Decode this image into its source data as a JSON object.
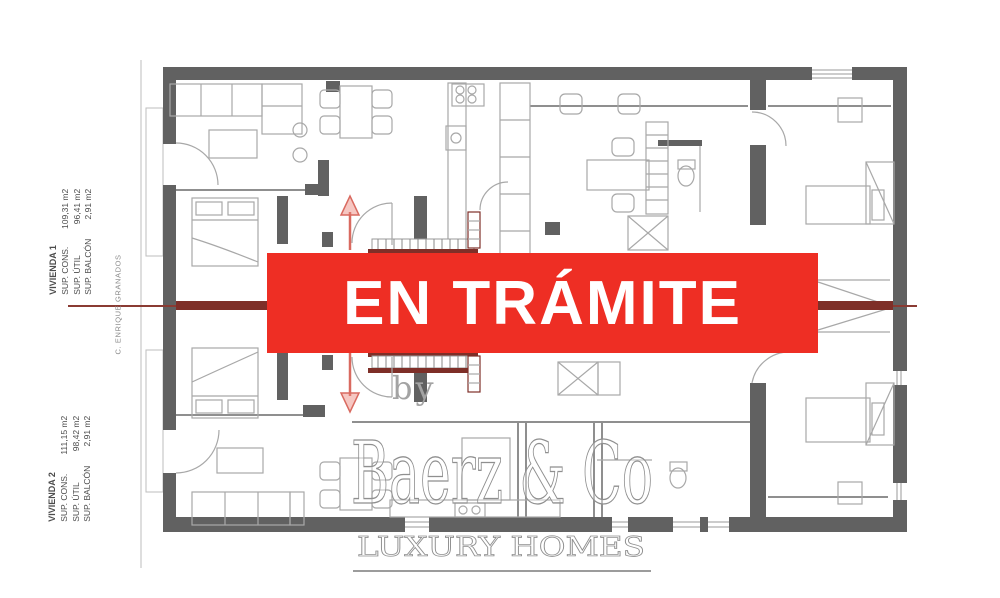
{
  "banner": {
    "text": "EN TRÁMITE",
    "bg_color": "#ee2e24",
    "text_color": "#ffffff"
  },
  "watermark": {
    "by": "by",
    "brand": "Baerz & Co",
    "tagline": "LUXURY HOMES"
  },
  "labels": {
    "vivienda1": {
      "title": "VIVIENDA 1",
      "rows": [
        {
          "name": "SUP. CONS.",
          "value": "109,31 m2"
        },
        {
          "name": "SUP. ÚTIL",
          "value": "96,41 m2"
        },
        {
          "name": "SUP. BALCÓN",
          "value": "2,91 m2"
        }
      ]
    },
    "vivienda2": {
      "title": "VIVIENDA 2",
      "rows": [
        {
          "name": "SUP. CONS.",
          "value": "111,15 m2"
        },
        {
          "name": "SUP. ÚTIL",
          "value": "98,42 m2"
        },
        {
          "name": "SUP. BALCÓN",
          "value": "2,91 m2"
        }
      ]
    },
    "street": "C. ENRIQUE GRANADOS"
  },
  "colors": {
    "wall": "#616161",
    "furniture": "#a8a8a8",
    "section_line": "#7e2f28",
    "banner_red": "#ee2e24",
    "watermark_gray": "#8f8f8f"
  }
}
